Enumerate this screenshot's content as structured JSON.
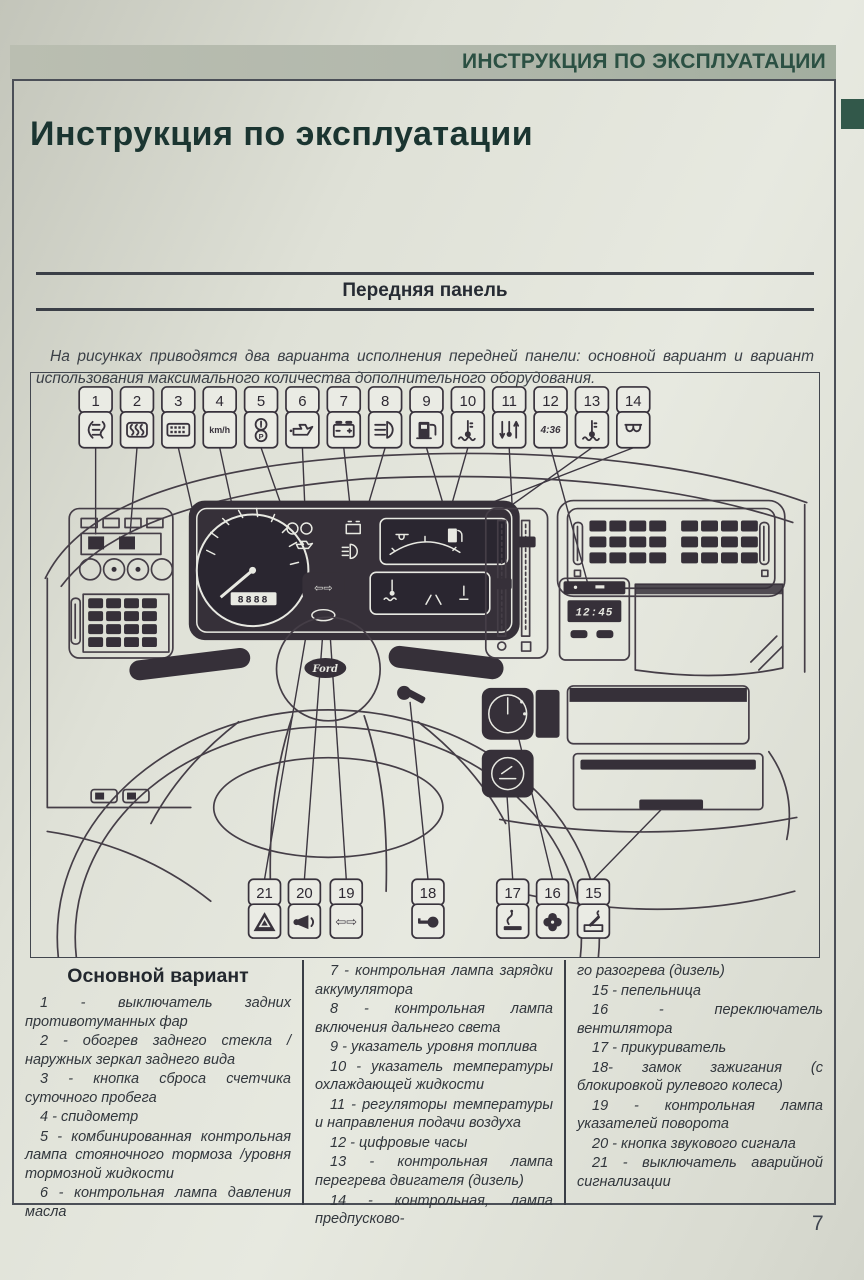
{
  "header": {
    "banner": "ИНСТРУКЦИЯ ПО ЭКСПЛУАТАЦИИ",
    "title": "Инструкция по эксплуатации"
  },
  "section": {
    "title": "Передняя панель",
    "intro": "На рисунках приводятся два варианта исполнения передней панели: основной вариант и вариант использования максимального количества дополнительного оборудования."
  },
  "diagram": {
    "top_callouts": [
      {
        "n": "1",
        "icon": "rear-fog-lamp"
      },
      {
        "n": "2",
        "icon": "rear-window-defrost"
      },
      {
        "n": "3",
        "icon": "trip-counter-reset"
      },
      {
        "n": "4",
        "icon": "speedometer",
        "text": "km/h"
      },
      {
        "n": "5",
        "icon": "parking-brake-warning"
      },
      {
        "n": "6",
        "icon": "oil-pressure"
      },
      {
        "n": "7",
        "icon": "battery-charge"
      },
      {
        "n": "8",
        "icon": "high-beam"
      },
      {
        "n": "9",
        "icon": "fuel-level"
      },
      {
        "n": "10",
        "icon": "coolant-temperature"
      },
      {
        "n": "11",
        "icon": "air-temperature-controls"
      },
      {
        "n": "12",
        "icon": "digital-clock",
        "text": "4:36"
      },
      {
        "n": "13",
        "icon": "engine-overheat"
      },
      {
        "n": "14",
        "icon": "glow-plug"
      }
    ],
    "bottom_callouts": [
      {
        "n": "21",
        "icon": "hazard-warning"
      },
      {
        "n": "20",
        "icon": "horn"
      },
      {
        "n": "19",
        "icon": "turn-signals",
        "text": "⇦⇨"
      },
      {
        "n": "18",
        "icon": "ignition-key"
      },
      {
        "n": "17",
        "icon": "cigarette-lighter"
      },
      {
        "n": "16",
        "icon": "fan"
      },
      {
        "n": "15",
        "icon": "ashtray"
      }
    ],
    "pad_arrows": "⇦⇨",
    "brand": "Ford",
    "odometer": "8888",
    "clock": "12:45"
  },
  "legend": {
    "heading": "Основной вариант",
    "col1": [
      "1 - выключатель задних противотуманных фар",
      "2 - обогрев заднего стекла / наружных зеркал заднего вида",
      "3 - кнопка сброса счетчика суточного пробега",
      "4 - спидометр",
      "5 - комбинированная контрольная лампа стояночного тормоза /уровня тормозной жидкости",
      "6 - контрольная лампа давления масла"
    ],
    "col2": [
      "7 - контрольная лампа зарядки аккумулятора",
      "8 - контрольная лампа включения дальнего света",
      "9 - указатель уровня топлива",
      "10 - указатель температуры охлаждающей жидкости",
      "11 - регуляторы температуры и направления подачи воздуха",
      "12 - цифровые часы",
      "13 - контрольная лампа перегрева двигателя (дизель)",
      "14 - контрольная, лампа предпусково-"
    ],
    "col3": [
      "го разогрева (дизель)",
      "15 - пепельница",
      "16 - переключатель вентилятора",
      "17 - прикуриватель",
      "18- замок зажигания (с блокировкой рулевого колеса)",
      "19 - контрольная лампа указателей поворота",
      "20 - кнопка звукового сигнала",
      "21 - выключатель аварийной сигнализации"
    ]
  },
  "page": {
    "number": "7"
  }
}
